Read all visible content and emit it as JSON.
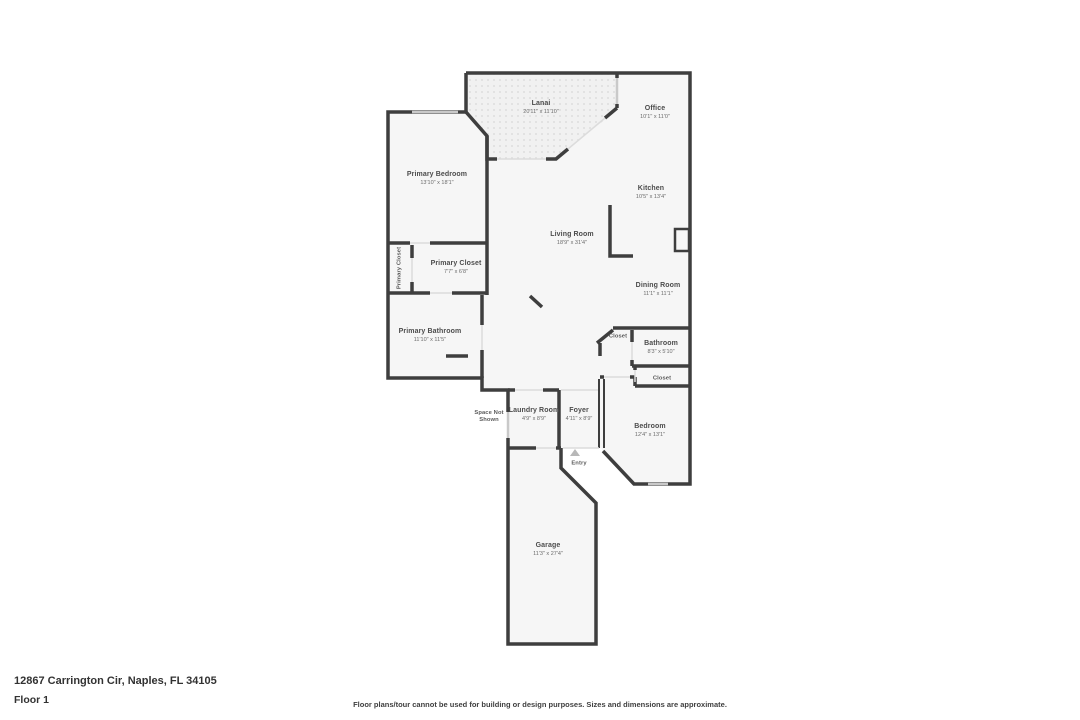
{
  "floorplan": {
    "wall_color": "#3e3e3e",
    "floor_color": "#f6f6f6",
    "window_color": "#c9c9c9",
    "opening_color": "#dcdcdc",
    "entry_arrow_color": "#b8b8b8",
    "rooms": [
      {
        "id": "lanai",
        "name": "Lanai",
        "dims": "20'11\" x 11'10\"",
        "x": 541,
        "y": 108
      },
      {
        "id": "office",
        "name": "Office",
        "dims": "10'1\" x 11'0\"",
        "x": 655,
        "y": 113
      },
      {
        "id": "primary-bedroom",
        "name": "Primary Bedroom",
        "dims": "13'10\" x 18'1\"",
        "x": 437,
        "y": 179
      },
      {
        "id": "kitchen",
        "name": "Kitchen",
        "dims": "10'5\" x 13'4\"",
        "x": 651,
        "y": 193
      },
      {
        "id": "living-room",
        "name": "Living Room",
        "dims": "18'9\" x 31'4\"",
        "x": 572,
        "y": 239
      },
      {
        "id": "primary-closet-vertical",
        "name": "Primary Closet",
        "dims": "",
        "x": 400,
        "y": 268,
        "rotate": true,
        "small": true
      },
      {
        "id": "primary-closet",
        "name": "Primary Closet",
        "dims": "7'7\" x 6'8\"",
        "x": 456,
        "y": 268
      },
      {
        "id": "dining-room",
        "name": "Dining Room",
        "dims": "11'1\" x 11'1\"",
        "x": 658,
        "y": 290
      },
      {
        "id": "primary-bathroom",
        "name": "Primary Bathroom",
        "dims": "11'10\" x 11'5\"",
        "x": 430,
        "y": 336
      },
      {
        "id": "closet-hall",
        "name": "Closet",
        "dims": "",
        "x": 618,
        "y": 337,
        "small": true
      },
      {
        "id": "bathroom",
        "name": "Bathroom",
        "dims": "8'3\" x 5'10\"",
        "x": 661,
        "y": 348
      },
      {
        "id": "closet-bedroom",
        "name": "Closet",
        "dims": "",
        "x": 662,
        "y": 379,
        "small": true
      },
      {
        "id": "space-not-shown",
        "name": "Space Not Shown",
        "dims": "",
        "x": 489,
        "y": 417,
        "small": true,
        "wrap": true
      },
      {
        "id": "laundry-room",
        "name": "Laundry Room",
        "dims": "4'9\" x 8'9\"",
        "x": 534,
        "y": 415
      },
      {
        "id": "foyer",
        "name": "Foyer",
        "dims": "4'11\" x 8'9\"",
        "x": 579,
        "y": 415
      },
      {
        "id": "bedroom",
        "name": "Bedroom",
        "dims": "12'4\" x 13'1\"",
        "x": 650,
        "y": 431
      },
      {
        "id": "entry",
        "name": "Entry",
        "dims": "",
        "x": 579,
        "y": 464,
        "small": true
      },
      {
        "id": "garage",
        "name": "Garage",
        "dims": "11'3\" x 27'4\"",
        "x": 548,
        "y": 550
      }
    ]
  },
  "footer": {
    "address": "12867 Carrington Cir, Naples, FL 34105",
    "floor_label": "Floor 1",
    "disclaimer": "Floor plans/tour cannot be used for building or design purposes. Sizes and dimensions are approximate."
  }
}
